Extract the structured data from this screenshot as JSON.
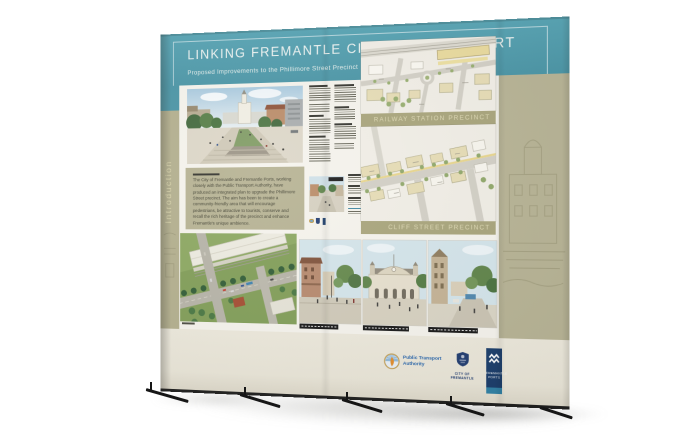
{
  "scene": {
    "description": "Photograph of a curved pop-up exhibition display wall on a white studio background",
    "colors": {
      "teal": "#4793a4",
      "olive": "#b2ae8c",
      "olive_band": "#a7a379",
      "cream": "#ebe7da",
      "paper": "#f5f3ec",
      "navy": "#173a68",
      "label_text": "#ddd8b2"
    }
  },
  "poster": {
    "title": "LINKING FREMANTLE CITY WITH THE PORT",
    "subtitle": "Proposed Improvements to the Phillimore Street Precinct",
    "side_label": "Introduction",
    "intro_paragraph": "The City of Fremantle and Fremantle Ports, working closely with the Public Transport Authority, have produced an integrated plan to upgrade the Phillimore Street precinct. The aim has been to create a community-friendly area that will encourage pedestrians, be attractive to tourists, conserve and recall the rich heritage of the precinct and enhance Fremantle's unique ambience.",
    "precinct_labels": [
      "RAILWAY STATION PRECINCT",
      "CLIFF STREET PRECINCT"
    ]
  },
  "logos": {
    "pta": {
      "name": "Public Transport Authority",
      "line1": "Public Transport",
      "line2": "Authority"
    },
    "city": {
      "name": "City of Fremantle",
      "line1": "CITY OF",
      "line2": "FREMANTLE"
    },
    "ports": {
      "name": "Fremantle Ports",
      "line1": "FREMANTLE",
      "line2": "PORTS"
    }
  }
}
